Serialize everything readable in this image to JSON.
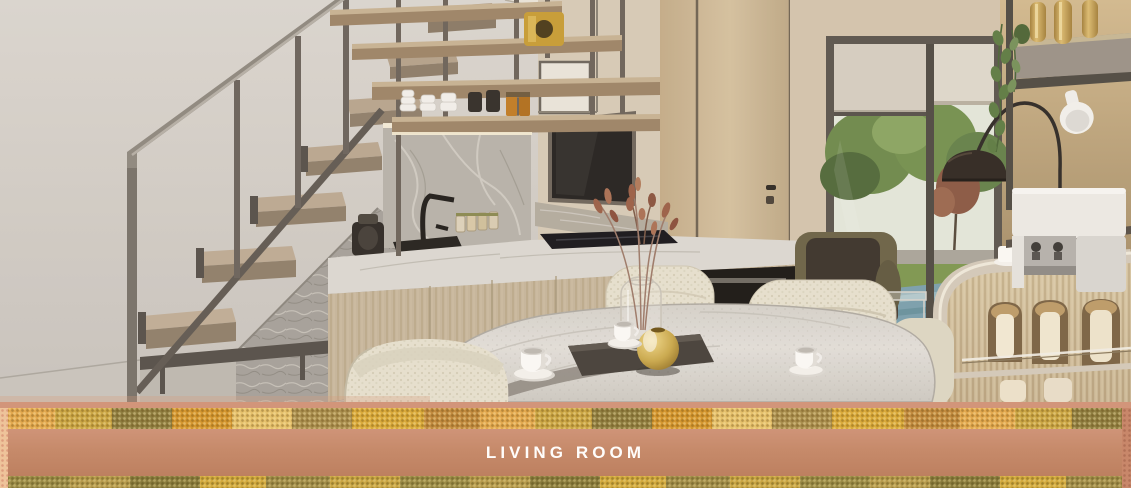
{
  "banner": {
    "label": "LIVING ROOM",
    "text_color": "#fffdfb",
    "bar_color": "#c68a6a",
    "top_strip_color": "#d2957a",
    "pattern_colors": [
      "#d4962f",
      "#caa544",
      "#8f7e41",
      "#e2a84e",
      "#e5c06b",
      "#a98e4e"
    ],
    "edge_left_color": "#eec39a",
    "edge_right_color": "#c8876a"
  },
  "scene": {
    "description": "3D interior rendering of an open-plan space: staircase on the left, kitchen with hanging shelves in the middle, marble dining table with cream boucle chairs in front, window with garden and pool view on the right, and a curved fluted bar island with a coffee machine at the far right.",
    "elements": [
      {
        "name": "staircase",
        "colors": [
          "#b3a28c",
          "#6a635c",
          "#a19b93"
        ]
      },
      {
        "name": "under-stair-stone-wall",
        "color": "#a5a19b"
      },
      {
        "name": "hanging-shelves",
        "items": [
          "white cup stacks",
          "dark mugs",
          "honey jars",
          "gold ornament"
        ]
      },
      {
        "name": "marble-backsplash",
        "color": "#b7b3ab"
      },
      {
        "name": "kitchen-counter",
        "colors": [
          "#dcd9d3",
          "#c6b69c"
        ]
      },
      {
        "name": "black-faucet",
        "color": "#1f1d1b"
      },
      {
        "name": "tv-panel",
        "color": "#2a2725"
      },
      {
        "name": "wood-door-wall",
        "color": "#cdbb9a"
      },
      {
        "name": "window",
        "view": [
          "trees",
          "red tree",
          "lawn",
          "road",
          "blue pool deck"
        ],
        "blinds": "half lowered"
      },
      {
        "name": "dark-armchair",
        "colors": [
          "#3a332c",
          "#6b6347"
        ]
      },
      {
        "name": "arc-floor-lamp",
        "shade_color": "#2f2822"
      },
      {
        "name": "hanging-plant",
        "color": "#5d7c44"
      },
      {
        "name": "wall-shelf-right",
        "items": [
          "brass bottles",
          "white spotlight"
        ]
      },
      {
        "name": "coffee-machine",
        "color": "#eceae6"
      },
      {
        "name": "bar-island",
        "style": "curved fluted wood with arched lit niches and glass shelf"
      },
      {
        "name": "dining-table",
        "material": "white marble"
      },
      {
        "name": "dining-chairs",
        "material": "cream boucle",
        "count": 4
      },
      {
        "name": "gold-sphere-vase",
        "color": "#c9a84c"
      },
      {
        "name": "glass-vase-with-dried-twigs",
        "twig_color": "#9a5f47"
      },
      {
        "name": "coffee-cups",
        "count": 3,
        "color": "#fbfaf8"
      },
      {
        "name": "dark-serving-tray",
        "color": "#45403a"
      }
    ]
  }
}
